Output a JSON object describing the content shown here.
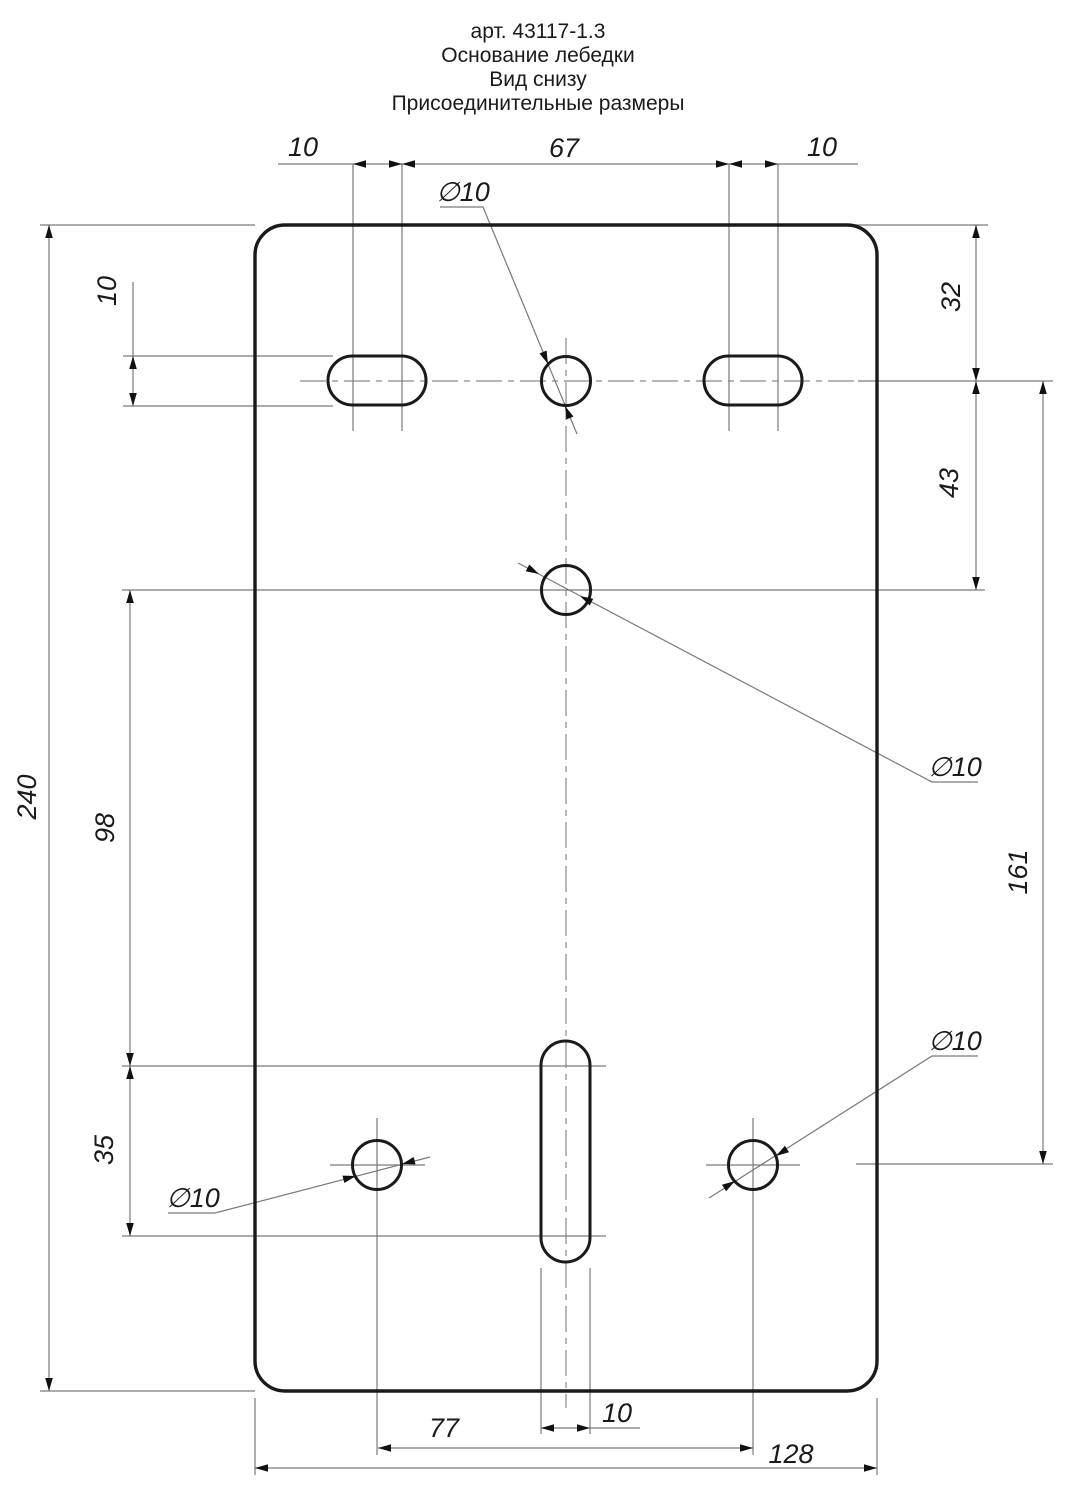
{
  "title": {
    "l1": "арт. 43117-1.3",
    "l2": "Основание лебедки",
    "l3": "Вид снизу",
    "l4": "Присоединительные размеры"
  },
  "dims": {
    "top_left_10": "10",
    "top_67": "67",
    "top_right_10": "10",
    "left_240": "240",
    "left_slot_height_10": "10",
    "left_98": "98",
    "left_35": "35",
    "right_32": "32",
    "right_43": "43",
    "right_161": "161",
    "bottom_77": "77",
    "bottom_slot_width_10": "10",
    "bottom_128": "128"
  },
  "dia": {
    "top": "∅10",
    "middle": "∅10",
    "bottom_left": "∅10",
    "bottom_right": "∅10"
  },
  "colors": {
    "outline": "#1a1a1a",
    "thin_line": "#7a7a7a",
    "text": "#1a1a1a",
    "background": "#ffffff"
  }
}
